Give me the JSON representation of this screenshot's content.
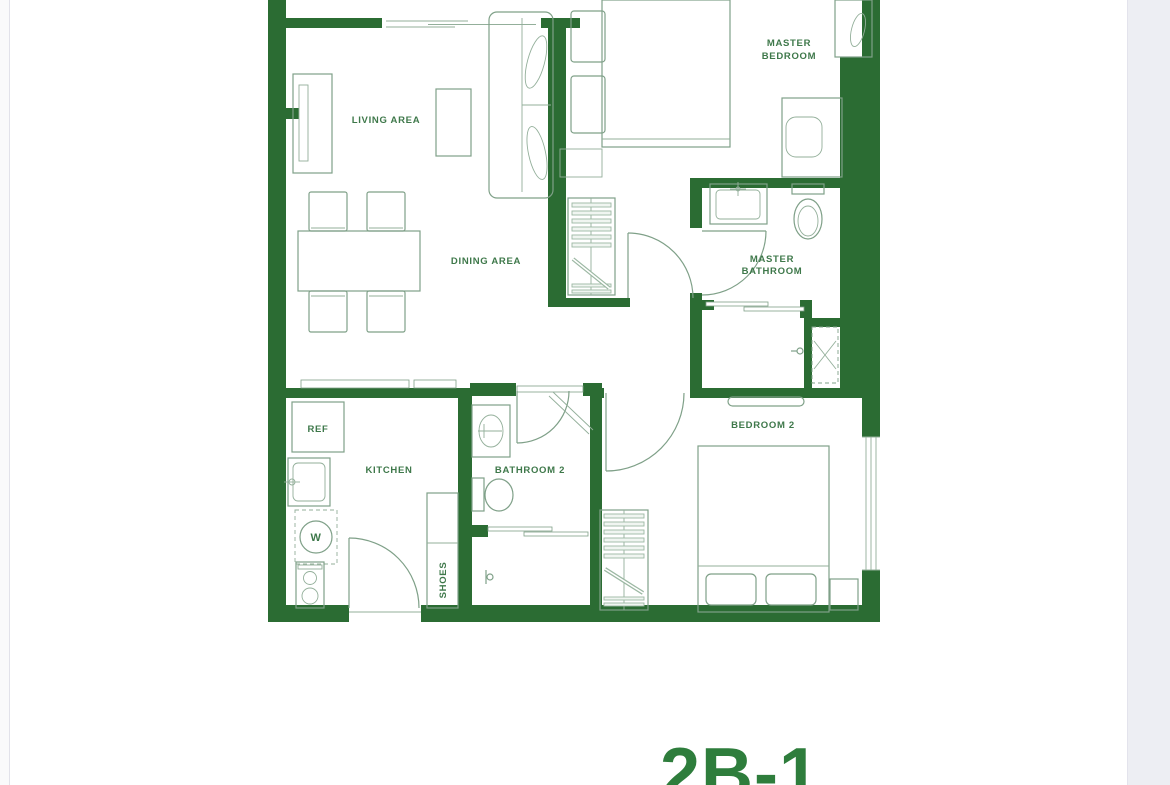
{
  "page": {
    "background": "#ffffff"
  },
  "gutters": {
    "left_color": "#fafafb",
    "right_color": "#edeef3"
  },
  "colors": {
    "wall": "#2b6c33",
    "line": "#7fa088",
    "line_soft": "#9cb8a3",
    "label": "#3e784a",
    "title": "#2e7d3c"
  },
  "floor_plan": {
    "rooms": {
      "living": {
        "label": "LIVING AREA"
      },
      "dining": {
        "label": "DINING AREA"
      },
      "kitchen": {
        "label": "KITCHEN"
      },
      "bathroom2": {
        "label": "BATHROOM 2"
      },
      "bedroom2": {
        "label": "BEDROOM 2"
      },
      "master_bedroom": {
        "line1": "MASTER",
        "line2": "BEDROOM"
      },
      "master_bathroom": {
        "line1": "MASTER",
        "line2": "BATHROOM"
      }
    },
    "fixtures": {
      "refrigerator": "REF",
      "washer": "W",
      "shoe_cabinet": "SHOES"
    }
  },
  "title": {
    "label": "2B-1"
  }
}
